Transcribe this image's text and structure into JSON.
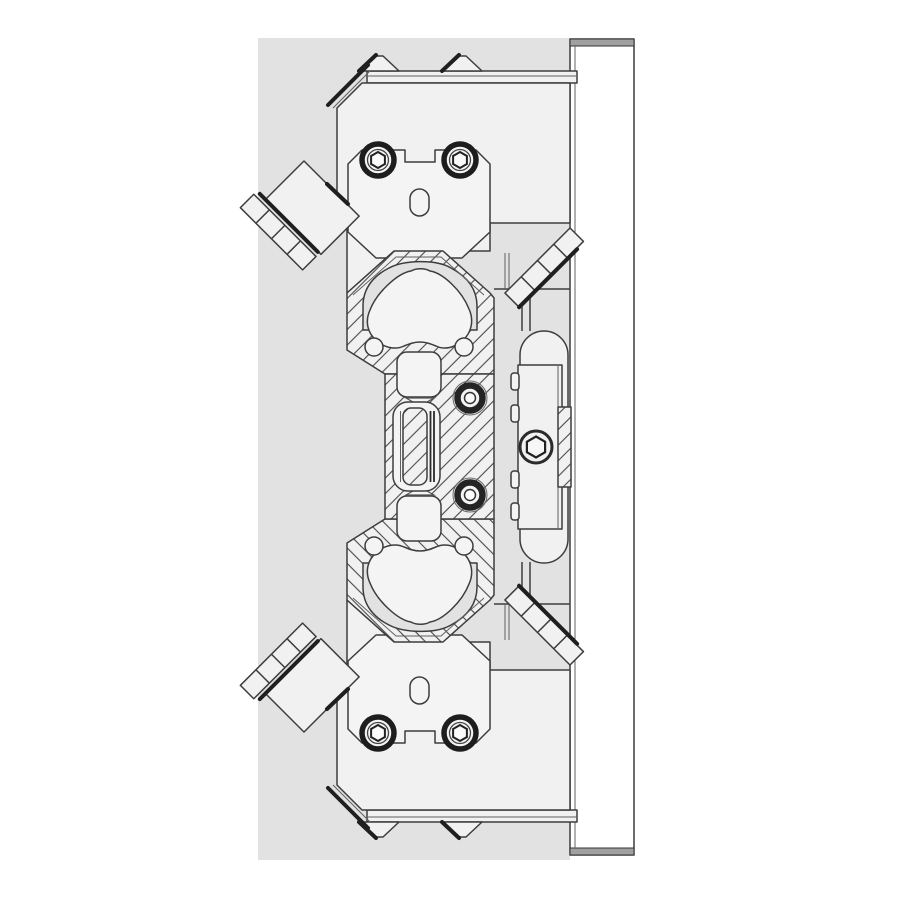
{
  "document": {
    "title": "Mechanical assembly cross-section CAD drawing",
    "view": "Section view, vertical orientation, no dimensions or text shown"
  },
  "colors": {
    "page_bg": "#ffffff",
    "canvas_bg": "#e2e2e2",
    "part_fill": "#f1f1f1",
    "plate_fill": "#ececec",
    "plate_band": "#a0a0a0",
    "outline": "#3d3d3d",
    "dark_accent": "#1f1f1f",
    "hatch_line": "#4a4a4a"
  },
  "parts": {
    "base_plate": "Mounting base plate (right side, full height)",
    "upper_jaw": "Upper jaw block with two socket head cap screws and slotted hole",
    "lower_jaw": "Lower jaw block (mirror of upper) with two socket head cap screws and slotted hole",
    "housing": "Central housing cross-section with hatched walls",
    "dome_cavities": "Arched cam cavities (top and bottom)",
    "cams": "Rounded triangular cam lobes (top and bottom)",
    "guide_rollers": "Two dark ring guide rollers beside piston slot",
    "pin_bores": "Four small pin bores at cavity bases",
    "piston_rod": "Hatched central piston rod in stadium slot",
    "pockets": "Rounded square spring pockets above and below slot",
    "left_arms": "Angled finger attachments with segmented wear strips (upper and lower left)",
    "right_strips": "Angled segmented strips toward base plate (upper and lower right)",
    "carriage": "Rail carriage with retaining bolt and hatched rail insert",
    "screws": "Hex socket head cap screws",
    "top_keys": "Beveled key tabs on upper rail face",
    "bottom_keys": "Beveled key tabs on lower rail face"
  }
}
